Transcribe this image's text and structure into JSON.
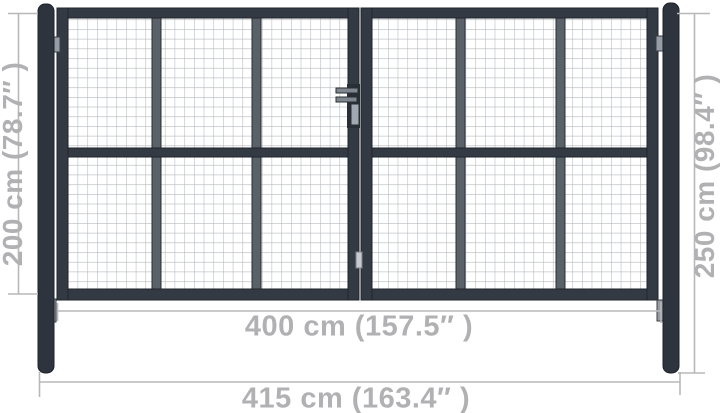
{
  "dimensions": {
    "gate_height_label": "200 cm (78.7″ )",
    "post_height_label": "250 cm (98.4″ )",
    "gate_width_label": "400 cm (157.5″ )",
    "total_width_label": "415 cm (163.4″ )"
  },
  "colors": {
    "background": "#ffffff",
    "frame": "#343a44",
    "frame_outline": "#1f242b",
    "divider": "#5b6169",
    "divider_outline": "#2a2f36",
    "post": "#2e343d",
    "post_outline": "#1d2127",
    "mesh_line": "#b4b8bc",
    "hinge": "#979da5",
    "latch_handle": "#81878f",
    "lock_cylinder": "#a3a9b0",
    "latch_keeper": "#c7cace",
    "dimension_line": "#b8b8b8",
    "dimension_text": "#b1b1b4"
  }
}
